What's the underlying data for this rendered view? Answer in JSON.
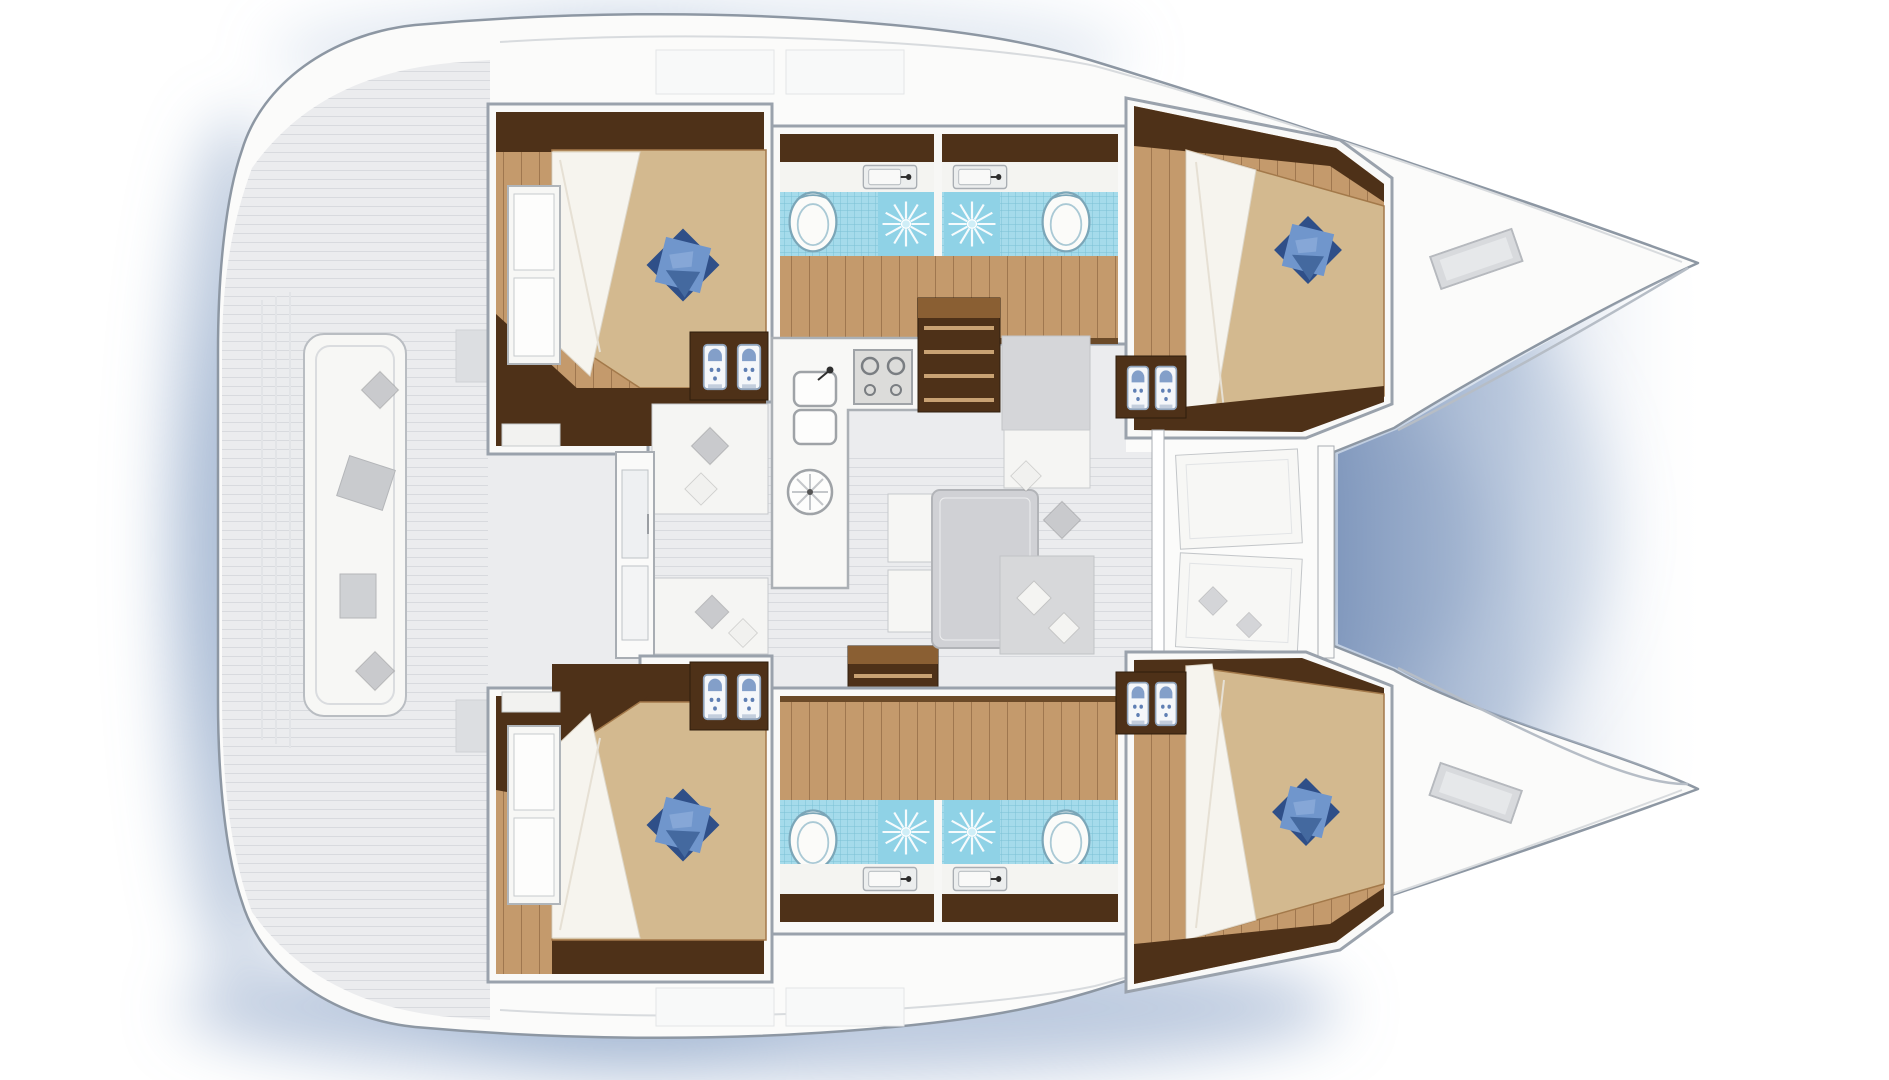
{
  "diagram": {
    "type": "catamaran-floor-plan",
    "view": "top-down",
    "orientation": "bow-right",
    "port_hull": {
      "rooms": [
        {
          "name": "aft cabin",
          "items": [
            "double berth",
            "star pillow",
            "storage shelves",
            "hanging lockers"
          ]
        },
        {
          "name": "aft bathroom",
          "items": [
            "toilet",
            "shower",
            "washbasin"
          ]
        },
        {
          "name": "forward bathroom",
          "items": [
            "toilet",
            "shower",
            "washbasin"
          ]
        },
        {
          "name": "forward cabin",
          "items": [
            "double berth",
            "star pillow",
            "hanging lockers"
          ]
        }
      ]
    },
    "starboard_hull": {
      "rooms": [
        {
          "name": "aft cabin",
          "items": [
            "double berth",
            "star pillow",
            "storage shelves",
            "hanging lockers"
          ]
        },
        {
          "name": "aft bathroom",
          "items": [
            "toilet",
            "shower",
            "washbasin"
          ]
        },
        {
          "name": "forward bathroom",
          "items": [
            "toilet",
            "shower",
            "washbasin"
          ]
        },
        {
          "name": "forward cabin",
          "items": [
            "double berth",
            "star pillow",
            "hanging lockers"
          ]
        }
      ]
    },
    "bridge_deck": {
      "rooms": [
        {
          "name": "cockpit",
          "items": [
            "transom bench",
            "seat cushions",
            "transom steps"
          ]
        },
        {
          "name": "salon",
          "items": [
            "galley counter",
            "double sink",
            "round sink",
            "stove",
            "dining table",
            "sofa benches",
            "scatter pillows",
            "companionway stairs port",
            "companionway stairs starboard",
            "sliding door"
          ]
        },
        {
          "name": "foredeck",
          "items": [
            "sun pads",
            "trampoline",
            "deck hatches"
          ]
        }
      ]
    },
    "counts": {
      "cabins": 4,
      "bathrooms": 4,
      "toilets": 4,
      "showers": 4,
      "washbasins": 4,
      "star_pillows": 4,
      "deck_hatches": 2,
      "stairs": 2
    }
  },
  "colors": {
    "background": "#ffffff",
    "water_shadow": "#a9bcd8",
    "water_shadow_deep": "#87a0c4",
    "hull_white": "#fbfbfa",
    "hull_outline": "#8d97a3",
    "deck_gray": "#ebecee",
    "wall_white": "#f9f9f8",
    "wood_dark": "#4e3118",
    "wood_mid": "#8a5f33",
    "wood_floor": "#c49a6c",
    "bed_beige": "#d3b98f",
    "sheet_white": "#f6f4ee",
    "pillow_blue_dark": "#2f4f88",
    "pillow_blue_light": "#7096cc",
    "pillow_blue_mid": "#44699f",
    "pillow_gray": "#c9cacd",
    "tile_blue": "#a5dbeb",
    "tile_grid": "#6fc0d8",
    "shower_blue": "#8fd2e6",
    "fixture_white": "#f4f4f1",
    "furniture_gray": "#d5d6d9",
    "table_gray": "#d0d1d5",
    "stove_gray": "#dcdcda",
    "stairs_step": "#c9a273"
  }
}
